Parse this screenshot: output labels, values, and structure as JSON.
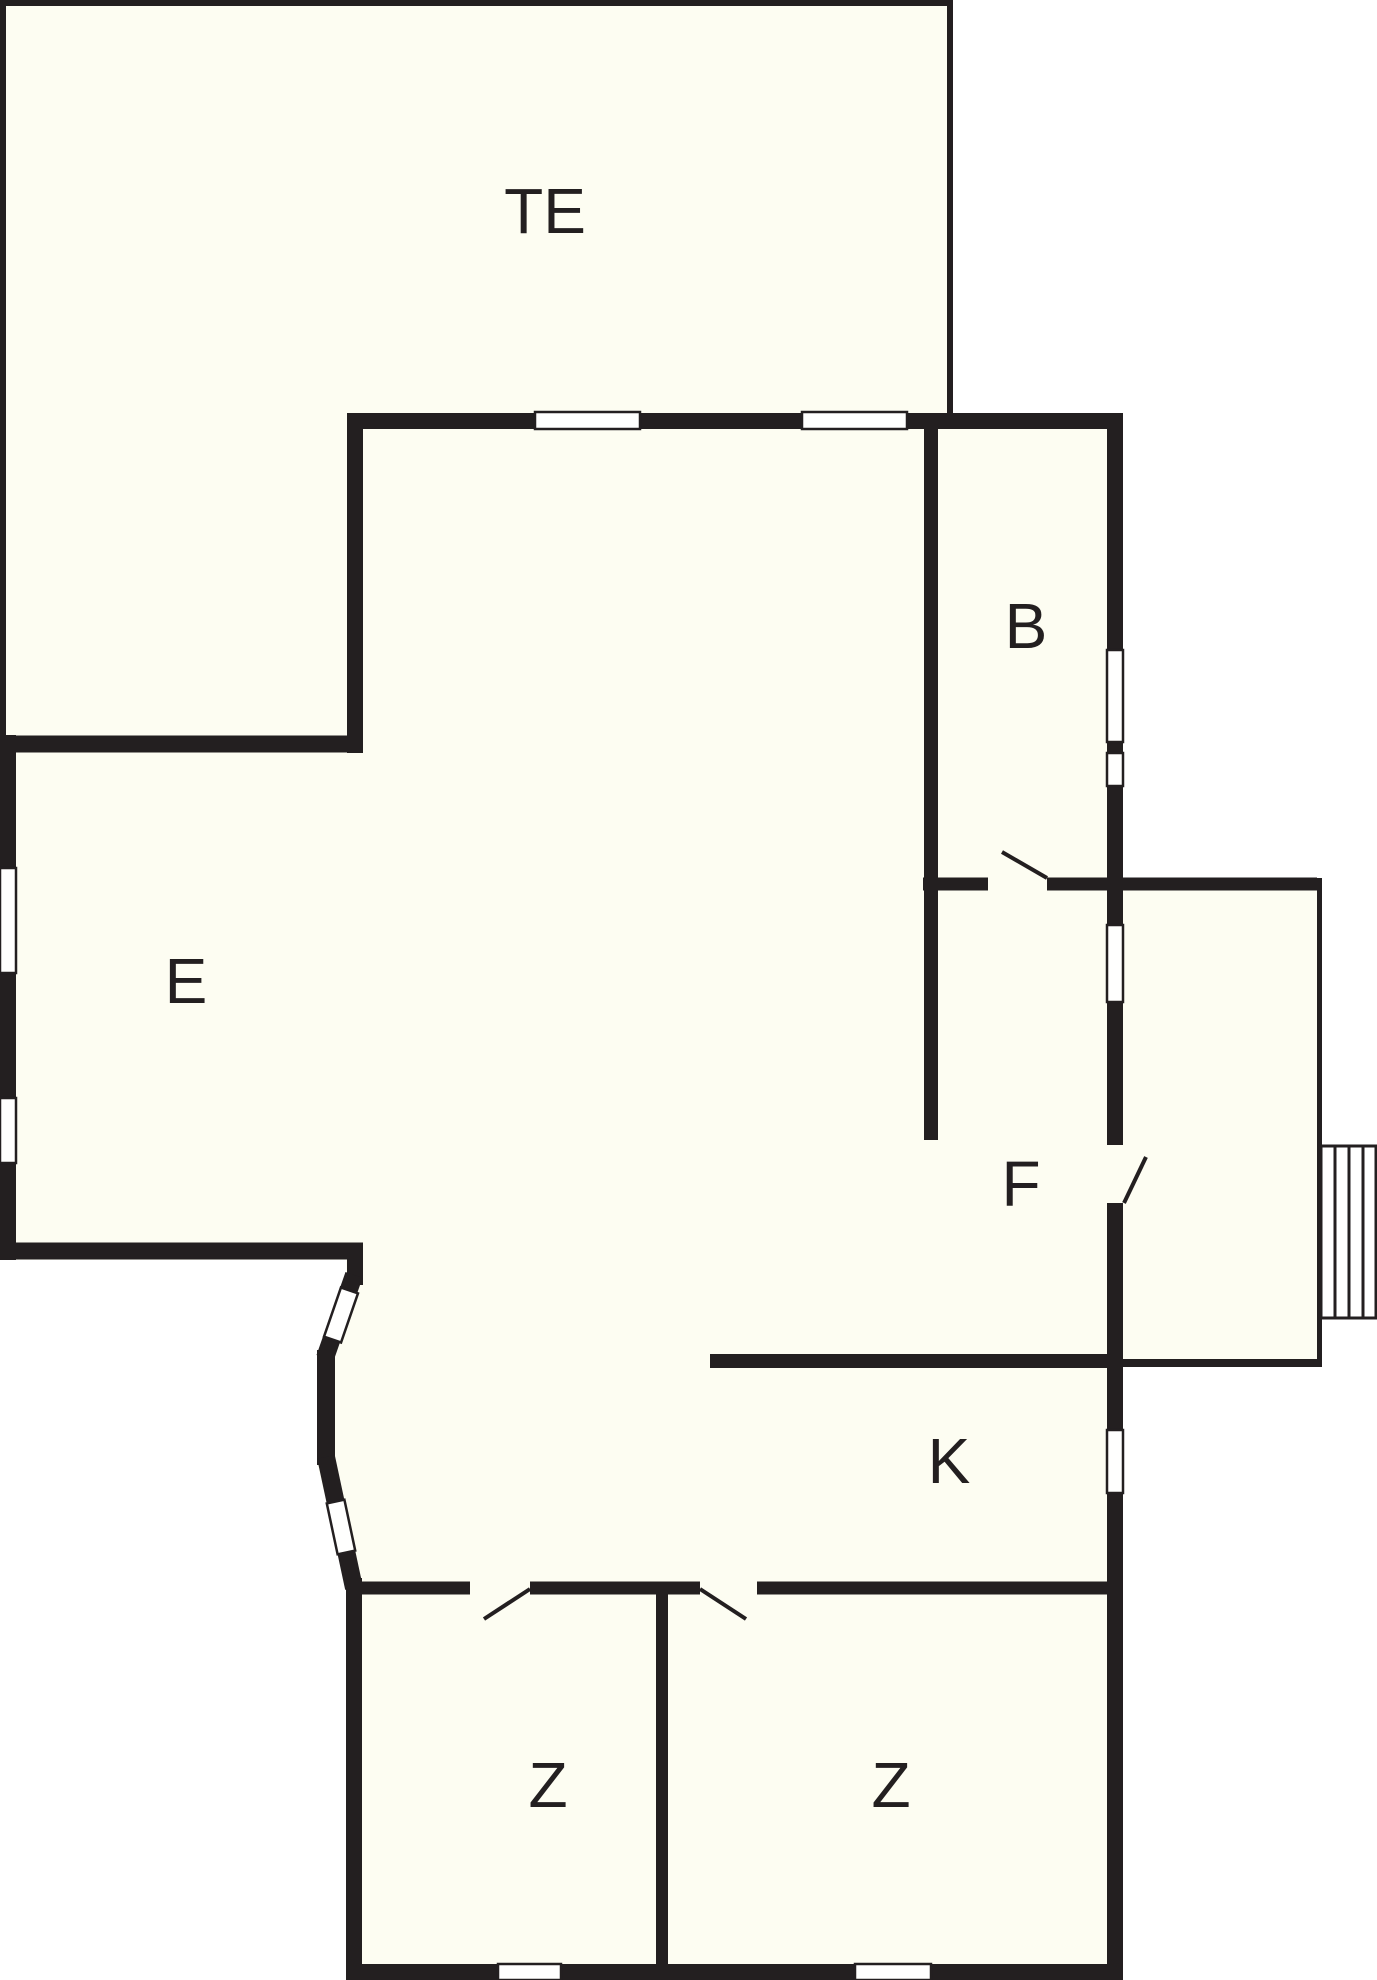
{
  "colors": {
    "wall": "#231f20",
    "floor": "#fdfdf2",
    "outside": "#ffffff",
    "window": "#fffffe"
  },
  "rooms": {
    "terrace": {
      "label": "TE"
    },
    "bathroom": {
      "label": "B"
    },
    "living": {
      "label": "E"
    },
    "hall": {
      "label": "F"
    },
    "kitchen": {
      "label": "K"
    },
    "bedroom_left": {
      "label": "Z"
    },
    "bedroom_right": {
      "label": "Z"
    }
  }
}
